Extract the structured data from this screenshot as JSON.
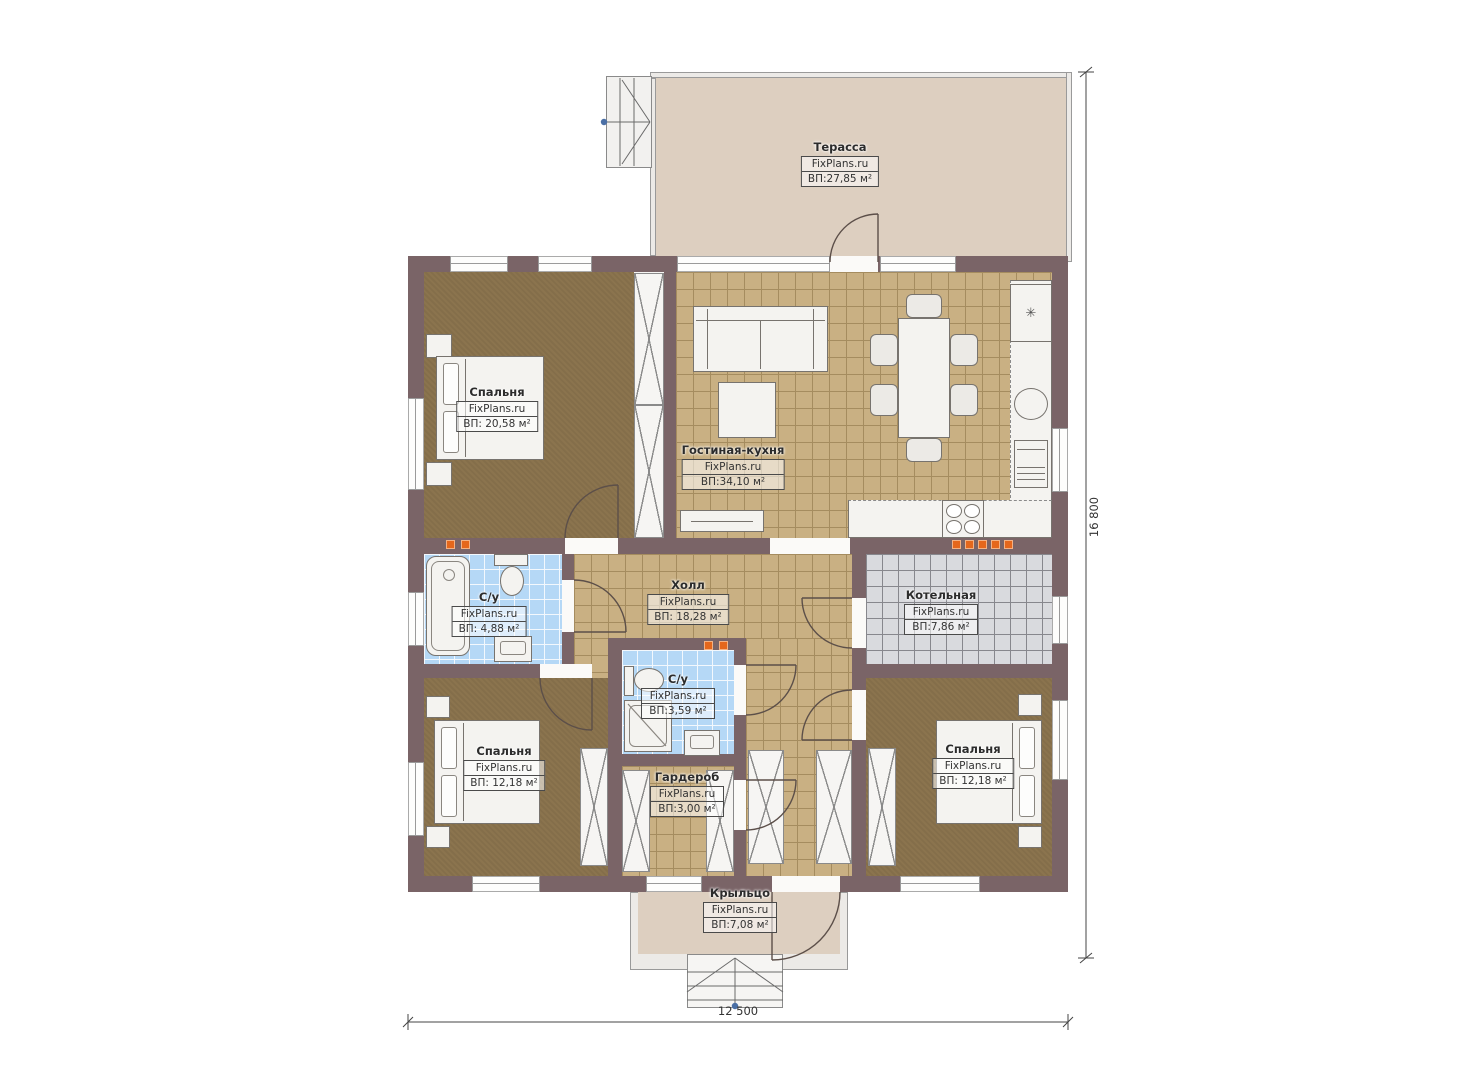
{
  "brand": "FixPlans.ru",
  "rooms": {
    "terrace": {
      "name": "Терасса",
      "area": "ВП:27,85 м²"
    },
    "bedroom_top": {
      "name": "Спальня",
      "area": "ВП: 20,58 м²"
    },
    "living_kitchen": {
      "name": "Гостиная-кухня",
      "area": "ВП:34,10 м²"
    },
    "bathroom_left": {
      "name": "С/у",
      "area": "ВП: 4,88 м²"
    },
    "hall": {
      "name": "Холл",
      "area": "ВП: 18,28 м²"
    },
    "boiler": {
      "name": "Котельная",
      "area": "ВП:7,86 м²"
    },
    "bathroom_mid": {
      "name": "С/у",
      "area": "ВП:3,59 м²"
    },
    "bedroom_bottom_left": {
      "name": "Спальня",
      "area": "ВП: 12,18 м²"
    },
    "wardrobe": {
      "name": "Гардероб",
      "area": "ВП:3,00 м²"
    },
    "bedroom_bottom_right": {
      "name": "Спальня",
      "area": "ВП: 12,18 м²"
    },
    "porch": {
      "name": "Крыльцо",
      "area": "ВП:7,08 м²"
    }
  },
  "dimensions": {
    "width_mm": "12 500",
    "height_mm": "16 800"
  },
  "icons": {
    "snowflake": "✳"
  },
  "colors": {
    "wall": "#7a6467",
    "tile_tan": "#c9b083",
    "carpet": "#8b744e",
    "tile_blue": "#b5d8f6",
    "tile_gray": "#d9dade",
    "terrace": "#ddcfc0",
    "radiator": "#e5671c",
    "marker_blue": "#4a6fa5"
  }
}
